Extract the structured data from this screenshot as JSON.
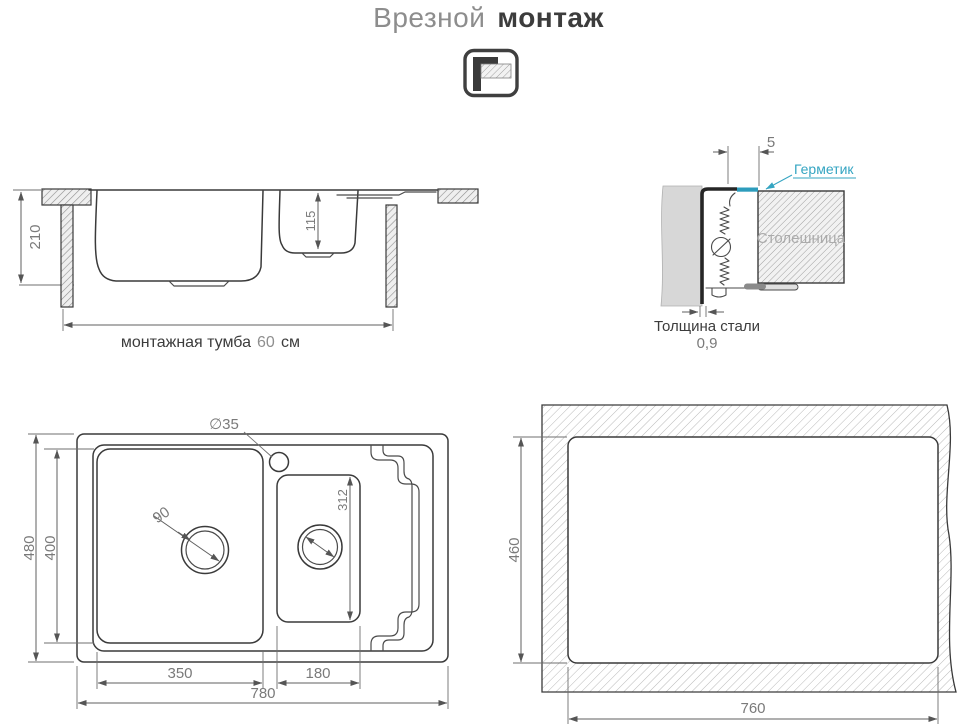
{
  "title": {
    "part1": "Врезной",
    "part2": "монтаж"
  },
  "colors": {
    "accent": "#35a5c2",
    "line": "#3a3a3a",
    "dim_text": "#7a7a7a"
  },
  "side_view": {
    "depth": "210",
    "small_bowl_depth": "115",
    "cabinet_label": "монтажная тумба",
    "cabinet_value": "60",
    "cabinet_unit": "см"
  },
  "detail_view": {
    "gap": "5",
    "sealant": "Герметик",
    "countertop": "Столешница",
    "steel_label": "Толщина стали",
    "steel_value": "0,9"
  },
  "top_view": {
    "faucet_hole": "∅35",
    "overall_depth": "480",
    "bowl_depth": "400",
    "drain": "90",
    "small_bowl_length": "312",
    "main_bowl_width": "350",
    "small_bowl_width": "180",
    "overall_width": "780"
  },
  "cutout_view": {
    "depth": "460",
    "width": "760"
  }
}
